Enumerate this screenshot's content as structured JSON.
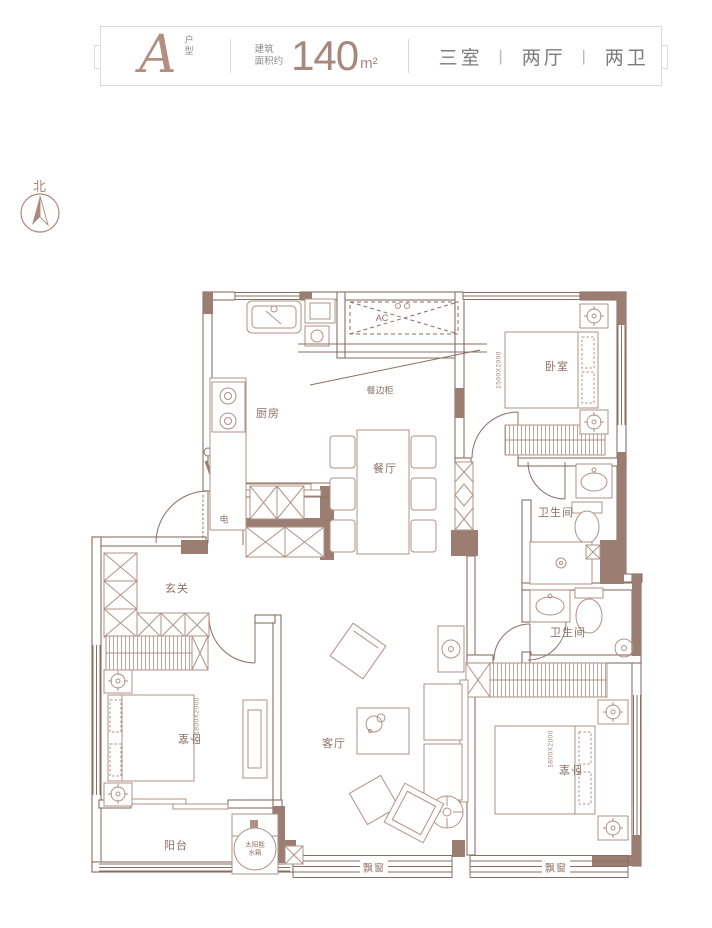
{
  "header": {
    "unit_letter": "A",
    "unit_type_label": "户型",
    "area_label_line1": "建筑",
    "area_label_line2": "面积约",
    "area_value": "140",
    "area_unit": "m²",
    "layout": {
      "rooms": "三室",
      "separator": "丨",
      "halls": "两厅",
      "baths": "两卫"
    }
  },
  "compass": {
    "north_label": "北"
  },
  "plan": {
    "rooms": {
      "kitchen": "厨房",
      "sideboard": "餐边柜",
      "dining": "餐厅",
      "bedroom_top_right": "卧室",
      "bathroom_upper": "卫生间",
      "bathroom_lower": "卫生间",
      "electrical_room": "电",
      "foyer": "玄关",
      "living_room": "客厅",
      "bedroom_left": "卧室",
      "bedroom_bottom_right": "卧室",
      "balcony": "阳台",
      "bay_window_center": "飘窗",
      "bay_window_right": "飘窗",
      "ac_unit": "AC"
    },
    "annotations": {
      "solar_line1": "太阳能",
      "solar_line2": "水箱",
      "bed_dim_top_right": "1500X2000",
      "bed_dim_left": "1800X2000",
      "bed_dim_bottom_right": "1800X2000"
    }
  },
  "colors": {
    "wall_fill": "#9b7d72",
    "wall_line": "#8a6e63",
    "furniture_line": "#b09186",
    "accent": "#ab8a7d",
    "header_text": "#7c7c7c"
  }
}
